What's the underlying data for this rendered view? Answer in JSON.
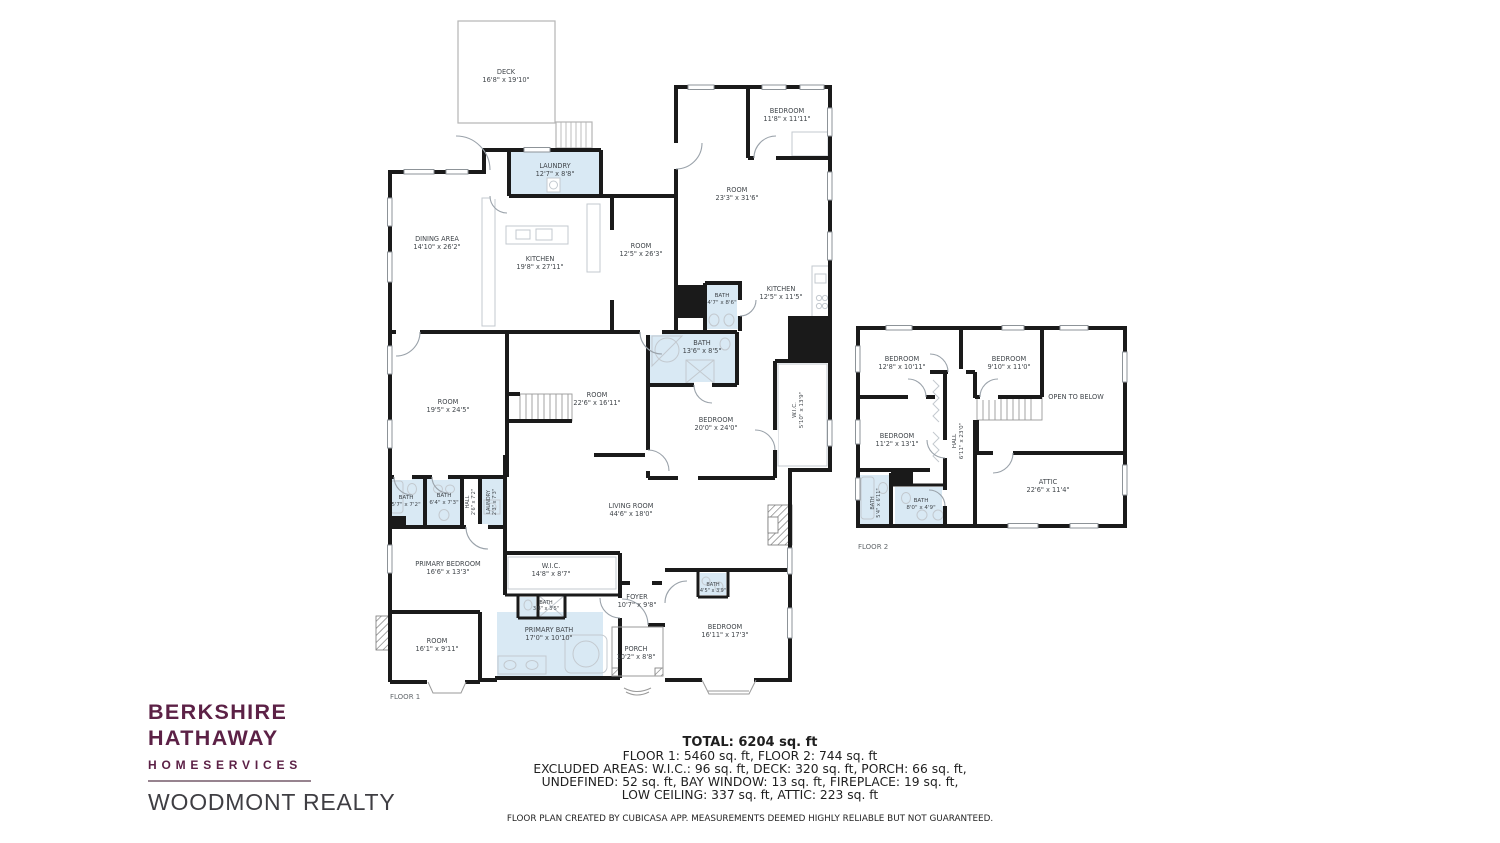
{
  "brand": {
    "line1": "BERKSHIRE",
    "line2": "HATHAWAY",
    "line3": "HOMESERVICES",
    "line4": "WOODMONT REALTY",
    "brand_color": "#5c2146",
    "realty_color": "#3f3e43"
  },
  "summary": {
    "total": "TOTAL: 6204 sq. ft",
    "lines": [
      "FLOOR 1: 5460 sq. ft, FLOOR 2: 744 sq. ft",
      "EXCLUDED AREAS: W.I.C.: 96 sq. ft, DECK: 320 sq. ft, PORCH: 66 sq. ft,",
      "UNDEFINED: 52 sq. ft, BAY WINDOW: 13 sq. ft, FIREPLACE: 19 sq. ft,",
      "LOW CEILING: 337 sq. ft, ATTIC: 223 sq. ft"
    ],
    "disclaimer": "FLOOR PLAN CREATED BY CUBICASA APP. MEASUREMENTS DEEMED HIGHLY RELIABLE BUT NOT GUARANTEED."
  },
  "floor1": {
    "label": "FLOOR 1",
    "rooms": [
      {
        "name": "DECK",
        "dims": "16'8\" x 19'10\""
      },
      {
        "name": "LAUNDRY",
        "dims": "12'7\" x 8'8\""
      },
      {
        "name": "DINING AREA",
        "dims": "14'10\" x 26'2\""
      },
      {
        "name": "KITCHEN",
        "dims": "19'8\" x 27'11\""
      },
      {
        "name": "ROOM",
        "dims": "12'5\" x 26'3\""
      },
      {
        "name": "BEDROOM",
        "dims": "11'8\" x 11'11\""
      },
      {
        "name": "ROOM",
        "dims": "23'3\" x 31'6\""
      },
      {
        "name": "KITCHEN",
        "dims": "12'5\" x 11'5\""
      },
      {
        "name": "BATH",
        "dims": "4'7\" x 8'6\""
      },
      {
        "name": "BATH",
        "dims": "13'6\" x 8'5\""
      },
      {
        "name": "ROOM",
        "dims": "19'5\" x 24'5\""
      },
      {
        "name": "ROOM",
        "dims": "22'6\" x 16'11\""
      },
      {
        "name": "BEDROOM",
        "dims": "20'0\" x 24'0\""
      },
      {
        "name": "W.I.C.",
        "dims": "5'10\" x 13'9\""
      },
      {
        "name": "BATH",
        "dims": "5'7\" x 7'2\""
      },
      {
        "name": "BATH",
        "dims": "6'4\" x 7'3\""
      },
      {
        "name": "HALL",
        "dims": "2'6\" x 7'2\""
      },
      {
        "name": "LAUNDRY",
        "dims": "2'3\" x 7'3\""
      },
      {
        "name": "PRIMARY BEDROOM",
        "dims": "16'6\" x 13'3\""
      },
      {
        "name": "LIVING ROOM",
        "dims": "44'6\" x 18'0\""
      },
      {
        "name": "W.I.C.",
        "dims": "14'8\" x 8'7\""
      },
      {
        "name": "BATH",
        "dims": "3'8\" x 3'5\""
      },
      {
        "name": "ROOM",
        "dims": "16'1\" x 9'11\""
      },
      {
        "name": "PRIMARY BATH",
        "dims": "17'0\" x 10'10\""
      },
      {
        "name": "FOYER",
        "dims": "10'7\" x 9'8\""
      },
      {
        "name": "PORCH",
        "dims": "10'2\" x 8'8\""
      },
      {
        "name": "BEDROOM",
        "dims": "16'11\" x 17'3\""
      },
      {
        "name": "BATH",
        "dims": "4'5\" x 3'9\""
      }
    ]
  },
  "floor2": {
    "label": "FLOOR 2",
    "rooms": [
      {
        "name": "BEDROOM",
        "dims": "12'8\" x 10'11\""
      },
      {
        "name": "BEDROOM",
        "dims": "9'10\" x 11'0\""
      },
      {
        "name": "OPEN TO BELOW",
        "dims": ""
      },
      {
        "name": "BEDROOM",
        "dims": "11'2\" x 13'1\""
      },
      {
        "name": "HALL",
        "dims": "6'11\" x 23'0\""
      },
      {
        "name": "ATTIC",
        "dims": "22'6\" x 11'4\""
      },
      {
        "name": "BATH",
        "dims": "5'4\" x 6'11\""
      },
      {
        "name": "BATH",
        "dims": "8'0\" x 4'9\""
      }
    ]
  },
  "colors": {
    "wall": "#1a1a1a",
    "wet_room_fill": "#d9e9f4",
    "fixture_line": "#c3c9cf",
    "door_arc": "#9aa2aa"
  }
}
